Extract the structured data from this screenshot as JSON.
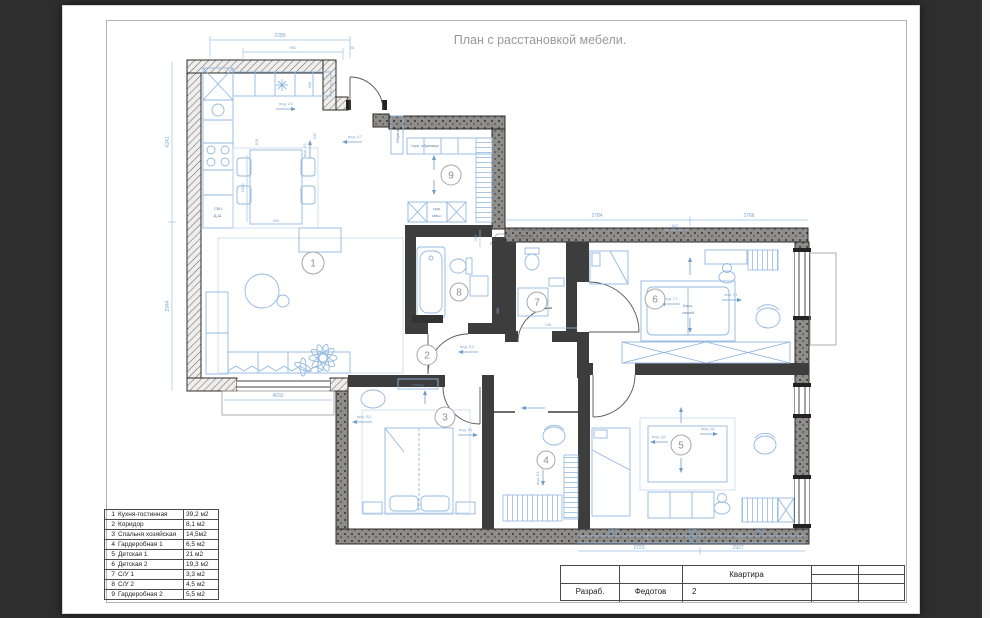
{
  "page": {
    "title": "План с расстановкой мебели."
  },
  "rooms": [
    {
      "num": "1",
      "name": "Кухня-гостинная",
      "area": "39,2 м2"
    },
    {
      "num": "2",
      "name": "Коридор",
      "area": "8,1 м2"
    },
    {
      "num": "3",
      "name": "Спальня хозяйская",
      "area": "14,5м2"
    },
    {
      "num": "4",
      "name": "Гардеробная 1",
      "area": "6,5 м2"
    },
    {
      "num": "5",
      "name": "Детская 1",
      "area": "21 м2"
    },
    {
      "num": "6",
      "name": "Детская 2",
      "area": "19,3 м2"
    },
    {
      "num": "7",
      "name": "С/У 1",
      "area": "3,3 м2"
    },
    {
      "num": "8",
      "name": "С/У 2",
      "area": "4,5 м2"
    },
    {
      "num": "9",
      "name": "Гардеробная 2",
      "area": "5,5 м2"
    }
  ],
  "titleblock": {
    "label_developed": "Разраб.",
    "developer": "Федотов",
    "project": "Квартира",
    "sheet": "2"
  },
  "annotations": {
    "installation_line1": "Инсталляция Grohe Rapid SL 38772001",
    "installation_line2": "500х1130",
    "air_hockey_line1": "Аэро-",
    "air_hockey_line2": "хоккей",
    "microwave": "СВЧ",
    "dish_washer": "Д.Ш.",
    "pouf_shoe": "пуф. обувница",
    "dryer_line1": "суш.",
    "dryer_line2": "маш.",
    "dresser": "комод",
    "shoe_cabinet": "Обувная"
  },
  "dims": {
    "top_main": "2285",
    "top_door": "900",
    "top_small": "96",
    "left_upper": "4241",
    "left_lower": "2944",
    "topright_left": "2784",
    "topright_mid": "622",
    "topright_right": "2766",
    "balcony": "4030",
    "bottom_r1a": "1256",
    "bottom_r1b": "3651",
    "bottom_r1c": "900",
    "bottom_r2": "5070",
    "bottom_r3a": "2723",
    "bottom_r3b": "2927",
    "bath_width": "748",
    "niche": "200",
    "wall_380": "380",
    "dining_width": "900",
    "dining_depth": "1500",
    "kitchen_a": "878",
    "kitchen_b": "942",
    "kitchen_c": "808"
  },
  "views": [
    "вид. А3",
    "вид. А5",
    "вид. А7",
    "вид. Б4",
    "вид. В1",
    "вид. В3",
    "вид. Г1",
    "вид. Г2",
    "вид. Д1",
    "вид. Д2",
    "вид. Е1"
  ],
  "colors": {
    "background": "#2e2e2e",
    "paper": "#ffffff",
    "furniture_blue": "#92b8e0",
    "dimension_blue": "#8fb4dc",
    "wall_dark": "#3d3d3d"
  }
}
